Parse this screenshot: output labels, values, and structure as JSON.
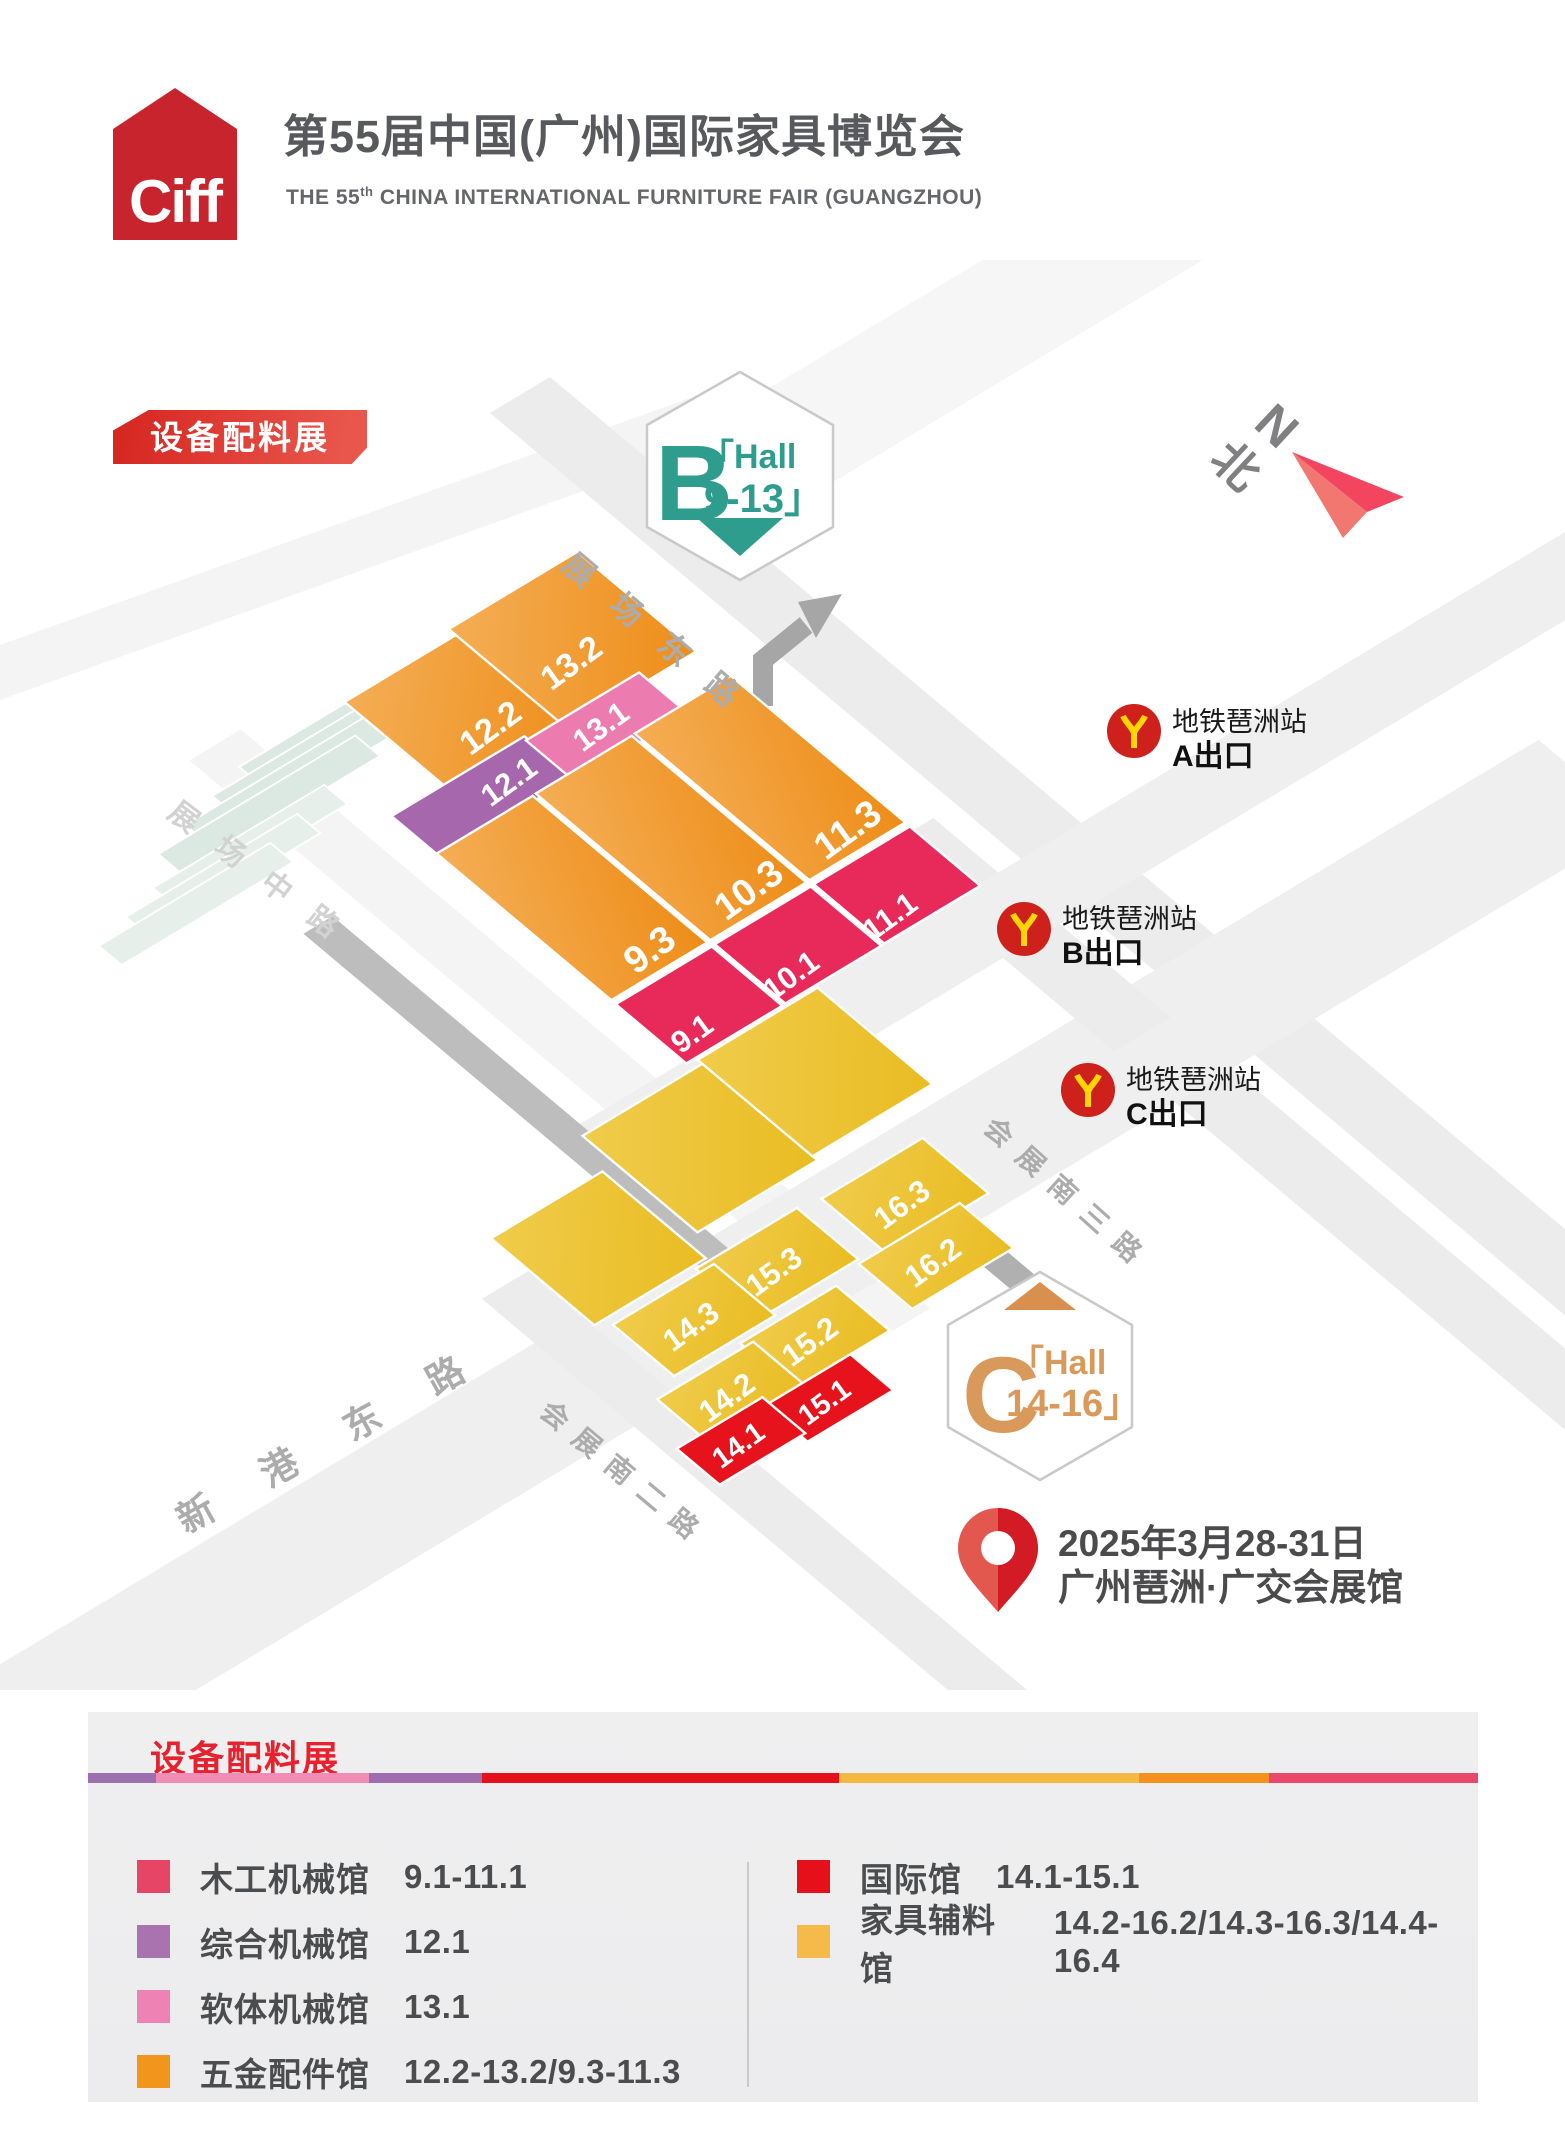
{
  "header": {
    "logo": "Ciff",
    "title": "第55届中国(广州)国际家具博览会",
    "subtitle_prefix": "THE 55",
    "subtitle_sup": "th",
    "subtitle_rest": " CHINA INTERNATIONAL FURNITURE FAIR (GUANGZHOU)"
  },
  "map": {
    "badge": "设备配料展",
    "north": {
      "cn": "北",
      "en": "N"
    },
    "badge_b": {
      "letter": "B",
      "line1": "「Hall",
      "line2": "9-13」"
    },
    "badge_c": {
      "letter": "C",
      "line1": "「Hall",
      "line2": "14-16」"
    },
    "roads": [
      {
        "name": "展场东路"
      },
      {
        "name": "展场中路"
      },
      {
        "name": "新港东路"
      },
      {
        "name": "会展南二路"
      },
      {
        "name": "会展南三路"
      }
    ],
    "halls": [
      {
        "label": "12.2"
      },
      {
        "label": "13.2"
      },
      {
        "label": "12.1"
      },
      {
        "label": "13.1"
      },
      {
        "label": "9.3"
      },
      {
        "label": "10.3"
      },
      {
        "label": "11.3"
      },
      {
        "label": "9.1"
      },
      {
        "label": "10.1"
      },
      {
        "label": "11.1"
      },
      {
        "label": "16.3"
      },
      {
        "label": "16.2"
      },
      {
        "label": "15.3"
      },
      {
        "label": "14.3"
      },
      {
        "label": "15.2"
      },
      {
        "label": "14.2"
      },
      {
        "label": "15.1"
      },
      {
        "label": "14.1"
      }
    ],
    "metro": {
      "station": "地铁琶洲站",
      "exits": [
        {
          "label": "A出口"
        },
        {
          "label": "B出口"
        },
        {
          "label": "C出口"
        }
      ]
    },
    "event": {
      "date": "2025年3月28-31日",
      "venue": "广州琶洲·广交会展馆"
    }
  },
  "legend": {
    "title": "设备配料展",
    "stripe_colors": [
      "#9B6FB0",
      "#F18CB7",
      "#A06CB0",
      "#E6101B",
      "#F5B843",
      "#F3921E",
      "#E9486B"
    ],
    "left_items": [
      {
        "name": "木工机械馆",
        "range": "9.1-11.1",
        "color": "#E64566"
      },
      {
        "name": "综合机械馆",
        "range": "12.1",
        "color": "#A873AE"
      },
      {
        "name": "软体机械馆",
        "range": "13.1",
        "color": "#EF82B5"
      },
      {
        "name": "五金配件馆",
        "range": "12.2-13.2/9.3-11.3",
        "color": "#F2951D"
      }
    ],
    "right_items": [
      {
        "name": "国际馆",
        "range": "14.1-15.1",
        "color": "#E6101B"
      },
      {
        "name": "家具辅料馆",
        "range": "14.2-16.2/14.3-16.3/14.4-16.4",
        "color": "#F6BA4A"
      }
    ]
  },
  "colors": {
    "brand_red": "#C8242E",
    "badge_red_gradient": [
      "#D5251F",
      "#E9564C"
    ],
    "hall_b_teal": "#2E9D8D",
    "hall_c_orange": "#D9995B",
    "hall_orange": "#F0992C",
    "hall_crimson": "#E72A59",
    "hall_purple": "#A767AD",
    "hall_pink": "#EC7BB0",
    "hall_yellow": "#EDC431",
    "hall_red": "#E6131D",
    "metro_red": "#CE211B",
    "metro_yellow": "#FFD503",
    "road_gray": "#ECECEC",
    "title_gray": "#58595C"
  }
}
